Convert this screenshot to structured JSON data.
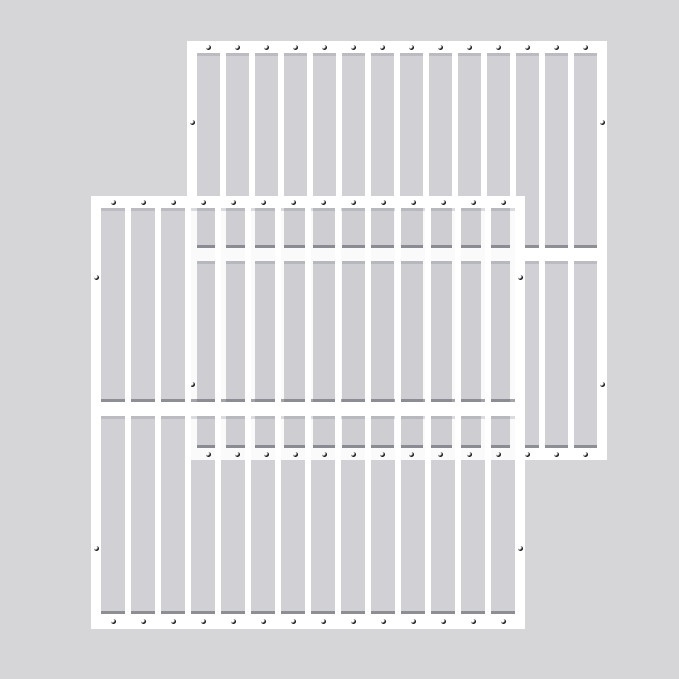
{
  "scene": {
    "description": "Two identical white steel window-security-bar grille panels overlapping diagonally on a plain light gray studio background; rear panel offset to the upper right, front panel offset to the lower left",
    "background_color": "#d6d6d9",
    "opening_tint": "rgba(55,55,70,0.025)",
    "grille_color": "#ffffff",
    "screw_color": "#17171b",
    "screw_highlight": "#ffffff",
    "shadow_dark": "rgba(75,75,86,0.50)",
    "shadow_soft": "rgba(110,110,122,0.22)",
    "screw_diameter_px": 5,
    "panels": [
      {
        "id": "back-grille",
        "label": "rear white security grille panel",
        "z": 1,
        "x": 187,
        "y": 41,
        "width": 420,
        "height": 419,
        "stile_width": 10,
        "top_rail_height": 12,
        "mid_rail_top": 207,
        "mid_rail_height": 13,
        "bottom_rail_top": 407,
        "bottom_rail_height": 12,
        "openings": 14,
        "bar_width": 6,
        "screw_rows": {
          "top_count": 14,
          "top_center_y": 6,
          "bottom_count": 14,
          "bottom_center_y": 413,
          "side_center_ys": [
            81,
            343
          ]
        }
      },
      {
        "id": "front-grille",
        "label": "front white security grille panel",
        "z": 2,
        "x": 91,
        "y": 196,
        "width": 434,
        "height": 433,
        "stile_width": 10,
        "top_rail_height": 12,
        "mid_rail_top": 206,
        "mid_rail_height": 14,
        "bottom_rail_top": 418,
        "bottom_rail_height": 15,
        "openings": 14,
        "bar_width": 6,
        "screw_rows": {
          "top_count": 14,
          "top_center_y": 6,
          "bottom_count": 14,
          "bottom_center_y": 425,
          "side_center_ys": [
            81,
            352
          ]
        }
      }
    ]
  }
}
